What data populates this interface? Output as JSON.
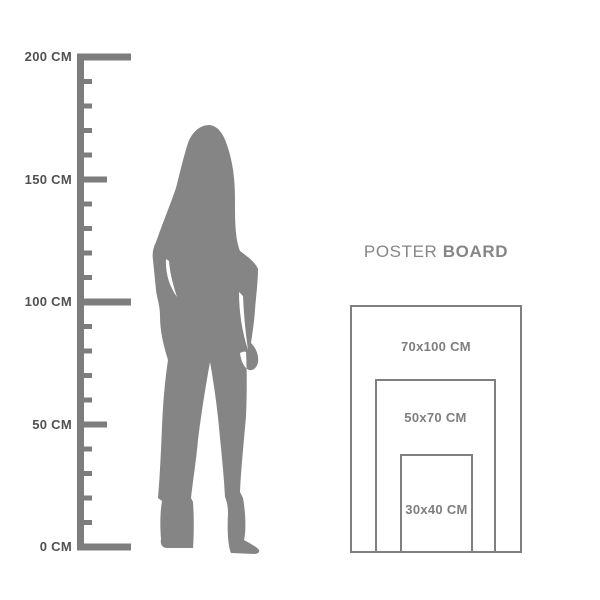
{
  "ruler": {
    "labels": [
      "200 CM",
      "150 CM",
      "100 CM",
      "50 CM",
      "0 CM"
    ]
  },
  "silhouette": {
    "icon": "standing-woman-silhouette"
  },
  "poster_board": {
    "title": {
      "regular": "POSTER",
      "bold": "BOARD"
    },
    "sizes": [
      "70x100 CM",
      "50x70 CM",
      "30x40 CM"
    ]
  },
  "colors": {
    "ruler": "#7d7d7d",
    "ruler_label_text": "#515151",
    "silhouette": "#858585",
    "box_border": "#7f7f7f",
    "box_label_text": "#7e7e7e",
    "title_text": "#868686",
    "background": "#ffffff"
  }
}
